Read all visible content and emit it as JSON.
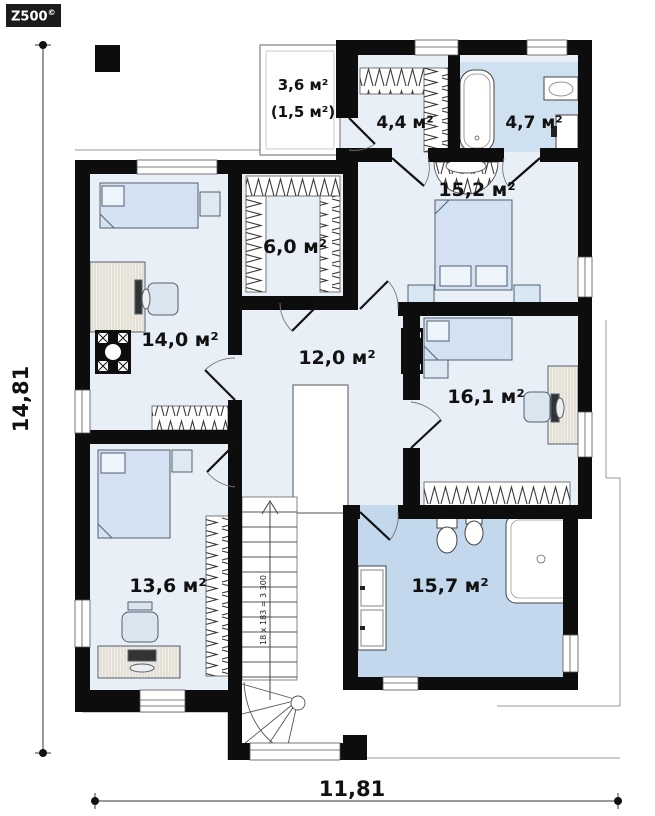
{
  "logo": {
    "brand": "Z500",
    "copyright_mark": "©"
  },
  "dimensions": {
    "height_label": "14,81",
    "width_label": "11,81"
  },
  "stairs": {
    "note": "18 x 183 = 3 300"
  },
  "rooms": [
    {
      "name": "attic-space",
      "area": "3,6 м²",
      "area_reduced": "(1,5 м²)"
    },
    {
      "name": "closet",
      "area": "4,4 м²"
    },
    {
      "name": "bathroom-small",
      "area": "4,7 м²"
    },
    {
      "name": "bedroom-1",
      "area": "15,2 м²"
    },
    {
      "name": "wardrobe",
      "area": "6,0 м²"
    },
    {
      "name": "bedroom-2",
      "area": "14,0 м²"
    },
    {
      "name": "hall",
      "area": "12,0 м²"
    },
    {
      "name": "bedroom-3",
      "area": "16,1 м²"
    },
    {
      "name": "bedroom-4",
      "area": "13,6 м²"
    },
    {
      "name": "bathroom-large",
      "area": "15,7 м²"
    }
  ],
  "colors": {
    "wall": "#0d0d0d",
    "room_fill": "#e9eff6",
    "bath_small_fill": "#cfe1f1",
    "bath_large_fill": "#c3d8ec",
    "furniture_fill": "#d3e1f2"
  }
}
